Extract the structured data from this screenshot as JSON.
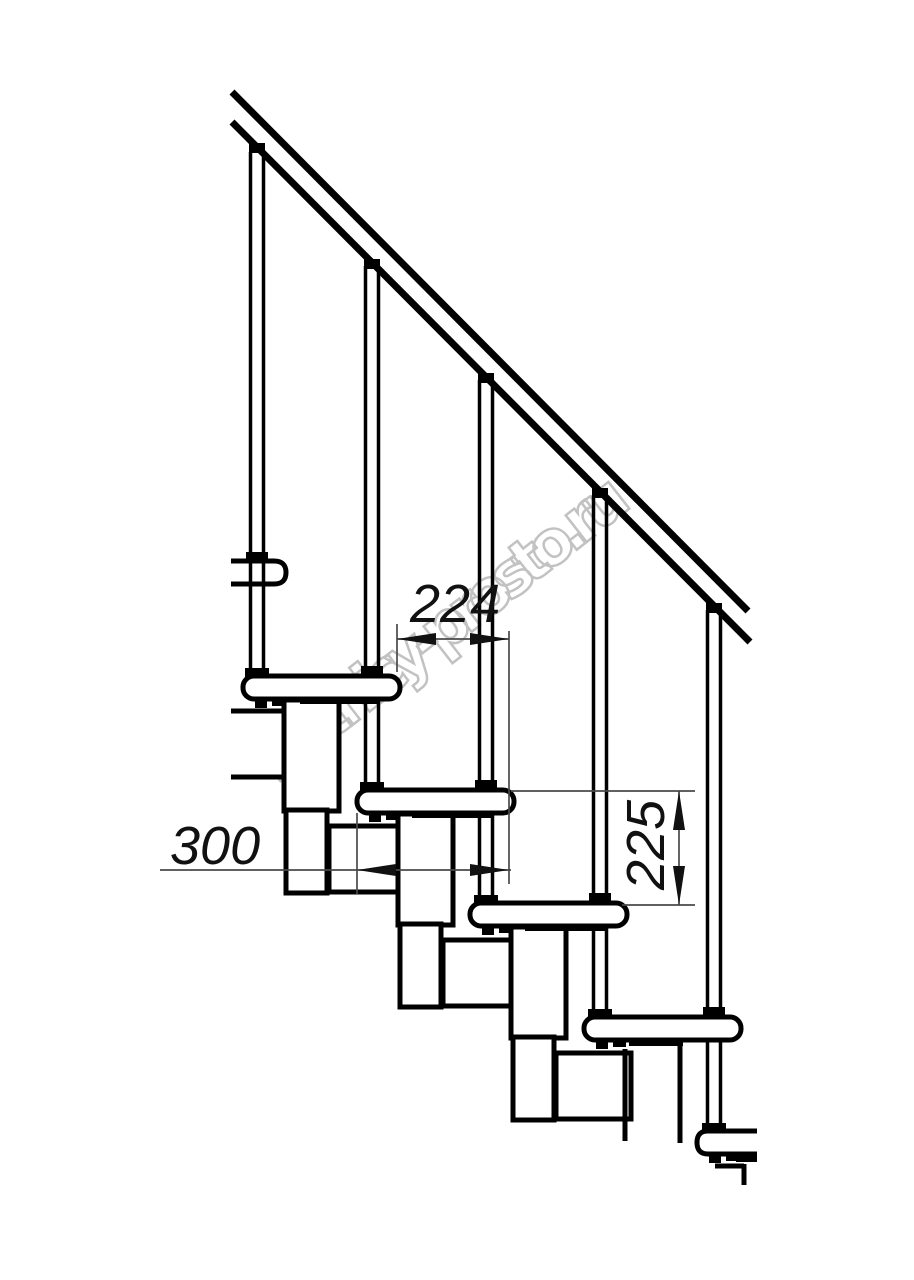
{
  "page": {
    "background": "#ffffff",
    "description": "Side-view technical line drawing of a modular staircase with handrail, balusters, treads and support modules"
  },
  "drawing": {
    "colors": {
      "line": "#000000",
      "dimension_line": "#4a4a4a",
      "text": "#111111",
      "watermark_stroke": "#c2c2c2"
    },
    "dimensions": [
      {
        "id": "step-going",
        "value": "224",
        "orientation": "horizontal"
      },
      {
        "id": "tread-depth",
        "value": "300",
        "orientation": "horizontal"
      },
      {
        "id": "step-rise",
        "value": "225",
        "orientation": "vertical"
      }
    ],
    "watermark": {
      "text": "lestnicy-prosto.ru"
    }
  }
}
